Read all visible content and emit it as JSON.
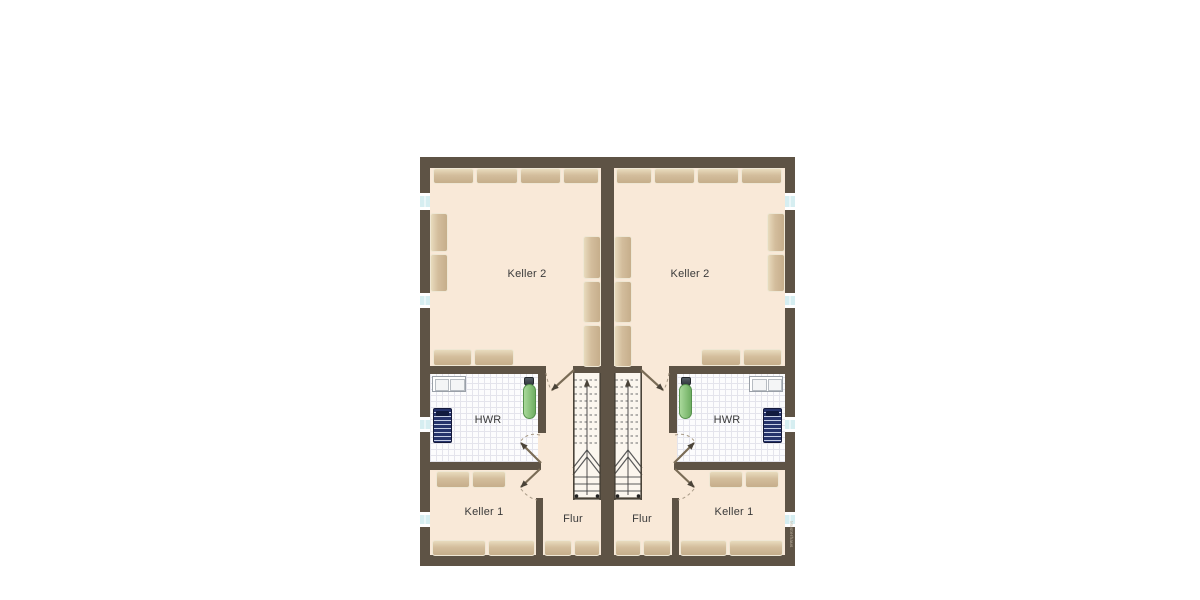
{
  "floorplan": {
    "kind": "basement-floorplan-duplex-mirrored",
    "watermark": "Musterhaus",
    "units": [
      {
        "side": "left",
        "rooms": {
          "keller2": {
            "label": "Keller 2"
          },
          "hwr": {
            "label": "HWR"
          },
          "keller1": {
            "label": "Keller 1"
          },
          "flur": {
            "label": "Flur"
          }
        }
      },
      {
        "side": "right",
        "rooms": {
          "keller2": {
            "label": "Keller 2"
          },
          "hwr": {
            "label": "HWR"
          },
          "keller1": {
            "label": "Keller 1"
          },
          "flur": {
            "label": "Flur"
          }
        }
      }
    ],
    "fixtures": [
      "staircase",
      "laundry-sink",
      "washing-machine",
      "ironing-board"
    ],
    "colors": {
      "wall": "#5e5345",
      "line_dark": "#4a4338",
      "floor": "#f9e9d8",
      "tile_floor": "#fcfcfd",
      "tile_grid": "#e4e4ec",
      "stair_floor": "#fbf6ee",
      "furniture_light": "#e8dbbd",
      "furniture_dark": "#c6ae8b",
      "window_glass": "#d6eef1",
      "door_leaf": "#7a6c56",
      "swing_arc": "#a89a86",
      "ironing_board_green": "#7cbb6e",
      "washer_navy": "#26336b",
      "label_text": "#3a3a3a"
    }
  }
}
